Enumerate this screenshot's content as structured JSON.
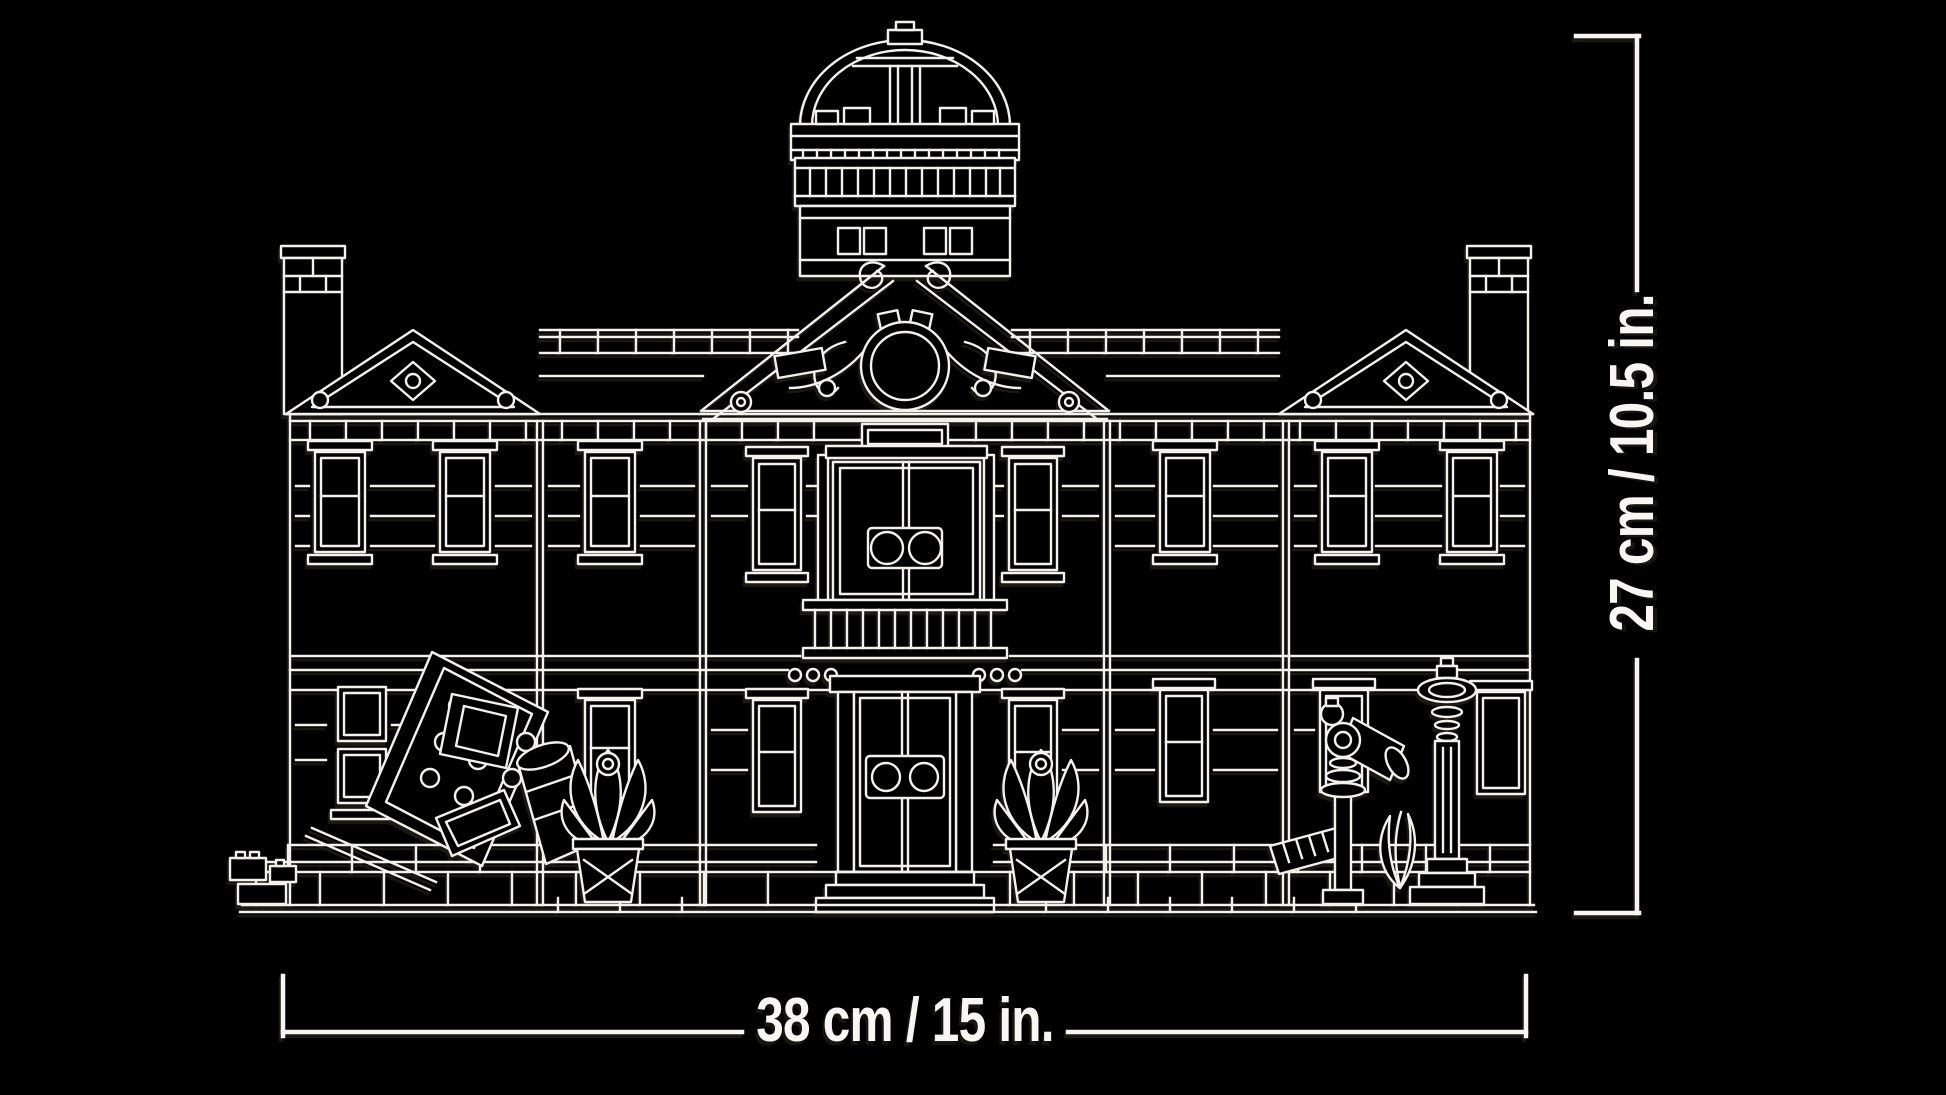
{
  "canvas": {
    "background": "#000000",
    "line_color": "#f2f1ec",
    "text_color": "#f7f6f2"
  },
  "illustration": {
    "kind": "lego-set-dimension-diagram",
    "subject": "Front elevation line art of a three-pavilion mansion with central dome, broken pediment, balcony with twin round-window doors, side chimneys, fallen debris, potted plants, hydrant and column"
  },
  "dimensions": {
    "width_label": "38 cm / 15 in.",
    "height_label": "27 cm / 10.5 in."
  }
}
